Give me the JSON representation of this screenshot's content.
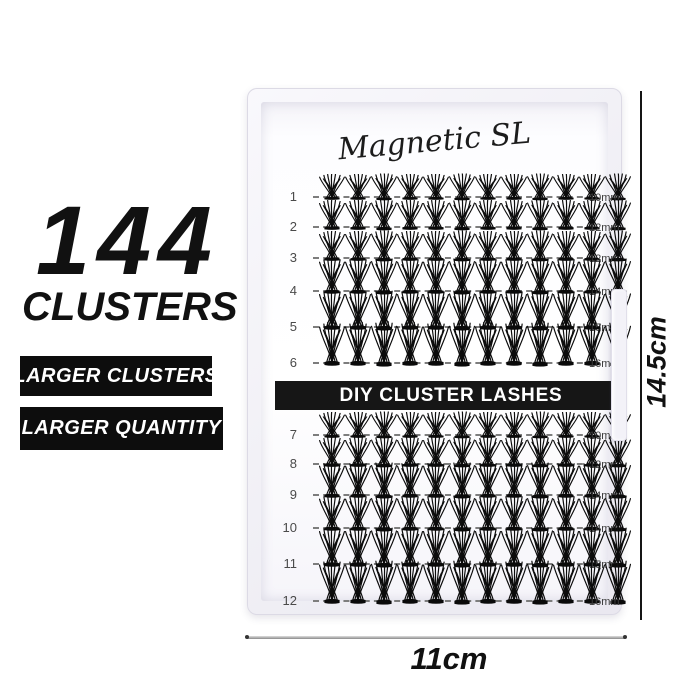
{
  "left_panel": {
    "headline_number": "144",
    "headline_label": "CLUSTERS",
    "badge_1": "LARGER CLUSTERS",
    "badge_2": "LARGER QUANTITY"
  },
  "tray": {
    "brand": "Magnetic SL",
    "banner": "DIY CLUSTER LASHES",
    "rows": [
      {
        "number": "1",
        "size": "10mm",
        "cluster_count": 12
      },
      {
        "number": "2",
        "size": "12mm",
        "cluster_count": 12
      },
      {
        "number": "3",
        "size": "12mm",
        "cluster_count": 12
      },
      {
        "number": "4",
        "size": "14mm",
        "cluster_count": 12
      },
      {
        "number": "5",
        "size": "15mm",
        "cluster_count": 12
      },
      {
        "number": "6",
        "size": "16mm",
        "cluster_count": 12
      },
      {
        "number": "7",
        "size": "10mm",
        "cluster_count": 12
      },
      {
        "number": "8",
        "size": "12mm",
        "cluster_count": 12
      },
      {
        "number": "9",
        "size": "14mm",
        "cluster_count": 12
      },
      {
        "number": "10",
        "size": "14mm",
        "cluster_count": 12
      },
      {
        "number": "11",
        "size": "15mm",
        "cluster_count": 12
      },
      {
        "number": "12",
        "size": "16mm",
        "cluster_count": 12
      }
    ]
  },
  "dimensions": {
    "height_label": "14.5cm",
    "width_label": "11cm"
  },
  "colors": {
    "badge_bg": "#0d0d0d",
    "banner_bg": "#161616",
    "lash_color": "#0b0b0b",
    "text_color": "#111111"
  }
}
